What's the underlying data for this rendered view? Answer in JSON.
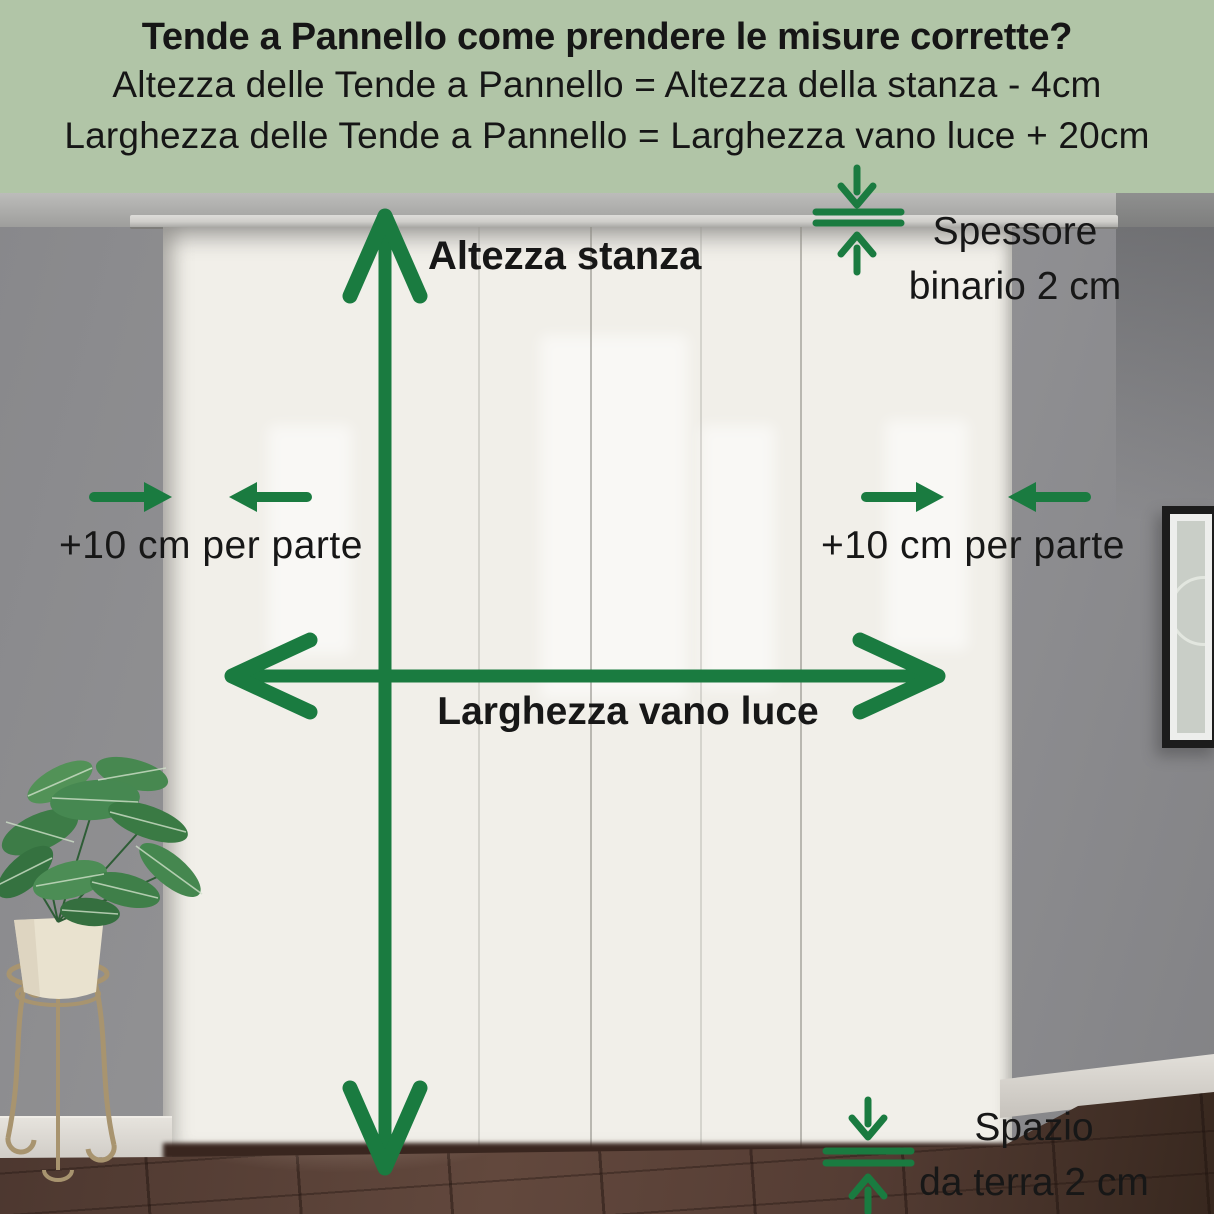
{
  "header": {
    "title": "Tende a Pannello come prendere le misure corrette?",
    "formula_height": "Altezza delle Tende a Pannello = Altezza della stanza - 4cm",
    "formula_width": "Larghezza delle Tende a Pannello = Larghezza vano luce + 20cm"
  },
  "annotations": {
    "room_height_label": "Altezza stanza",
    "track_thickness_line1": "Spessore",
    "track_thickness_line2": "binario 2 cm",
    "side_margin_left_label": "+10 cm per parte",
    "side_margin_right_label": "+10 cm per parte",
    "opening_width_label": "Larghezza vano luce",
    "floor_gap_line1": "Spazio",
    "floor_gap_line2": "da terra 2 cm"
  },
  "colors": {
    "arrow_green": "#1a7b40",
    "header_bg": "#b1c5a7",
    "header_text": "#161616",
    "label_text": "#171717",
    "wall": "#8d8d8f",
    "curtain": "#f1efe9",
    "floor": "#543c33",
    "baseboard": "#d9d6d0",
    "ceiling": "#b3b3b1",
    "rail": "#cfceca",
    "leaf_green": "#3d7c47",
    "pot": "#e9e2cf",
    "stand_metal": "#a8946f",
    "frame": "#1c1c1c"
  },
  "scene": {
    "objects": [
      "wall",
      "ceiling",
      "curtain-rail",
      "panel-curtains",
      "tiled-floor",
      "marble-baseboard",
      "potted-plant",
      "plant-stand",
      "picture-frame"
    ]
  }
}
